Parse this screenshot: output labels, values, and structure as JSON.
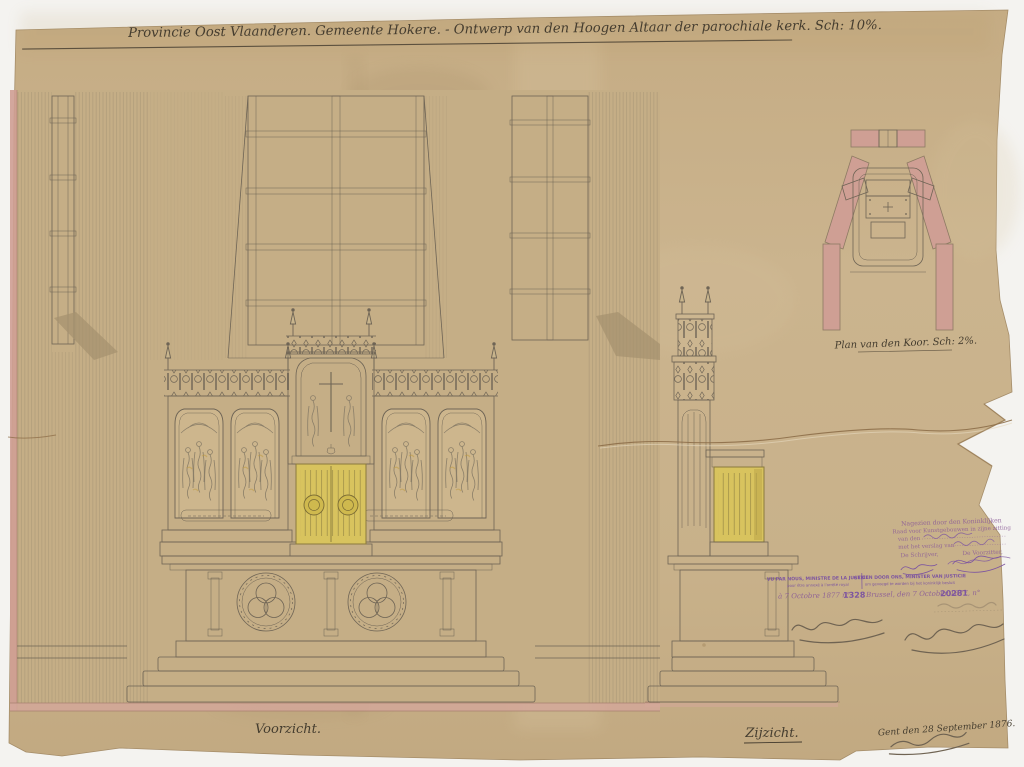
{
  "colors": {
    "paper": "#c9b28b",
    "pink_wash": "#cf9f94",
    "gold_wash": "#d8c35e",
    "ink": "#6e6455",
    "stamp_violet": "#8a5b97",
    "pencil": "#6f6352",
    "background": "#f4f3f0"
  },
  "title": {
    "text": "Provincie Oost Vlaanderen.  Gemeente Hokere. - Ontwerp van den Hoogen Altaar der parochiale kerk.  Sch: 10%."
  },
  "views": {
    "front": {
      "label": "Voorzicht."
    },
    "side": {
      "label": "Zijzicht."
    },
    "plan": {
      "label": "Plan van den Koor. Sch: 2%."
    }
  },
  "stamps": {
    "royal_commission": {
      "line1": "Nagezien door den Koninklijken",
      "line2": "Raad voor Kunstgebouwen in zijne zitting",
      "line3": "van den",
      "line4": "met het verslag van",
      "secretary": "De Schrijver,",
      "chairman": "De Voorzitter,"
    },
    "minister_fr": {
      "line1": "VU PAR NOUS, MINISTRE DE LA JUSTICE",
      "line2": "pour être annexé à l'arrêté royal",
      "note": "à 7 Octobre 1877 n°",
      "number": "1328"
    },
    "minister_nl": {
      "line1": "GEZIEN DOOR ONS, MINISTER VAN JUSTICIE",
      "line2": "om gevoegd te worden bij het koninklijk besluit",
      "note": "Brussel, den 7 October 1877, n°",
      "number": "20281"
    }
  },
  "notes": {
    "city_date": "Gent den 28 September 1876."
  }
}
